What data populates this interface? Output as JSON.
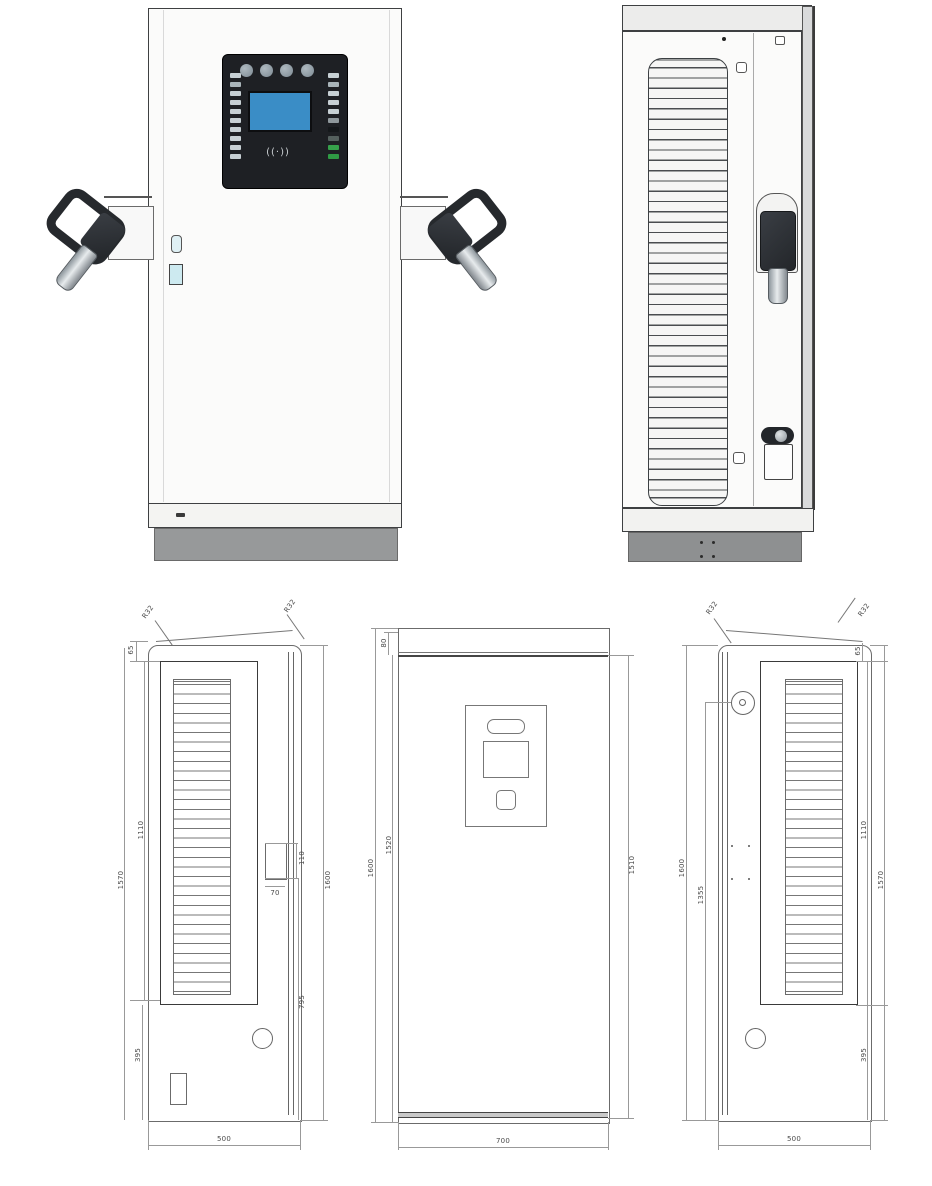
{
  "front_render": {
    "rfid_symbol": "((·))",
    "screen_color": "#3a8dc6",
    "panel_color": "#1e2024",
    "led_colors_left": [
      "#c7d0d4",
      "#a9b4b9",
      "#c7d0d4",
      "#c7d0d4",
      "#c7d0d4",
      "#c7d0d4",
      "#c7d0d4",
      "#c7d0d4",
      "#c7d0d4",
      "#c7d0d4"
    ],
    "led_colors_right": [
      "#c7d0d4",
      "#a9b4b9",
      "#c7d0d4",
      "#c7d0d4",
      "#c7d0d4",
      "#8f989c",
      "#15181b",
      "#55605e",
      "#36a14b",
      "#2f9a44"
    ]
  },
  "drawings": {
    "left": {
      "r32_left": "R32",
      "r32_right": "R32",
      "top_inset": "65",
      "overall": "1570",
      "louver": "1110",
      "cutout_h": "110",
      "cutout_w": "70",
      "full_height": "1600",
      "lower": "795",
      "base": "395",
      "depth": "500"
    },
    "front": {
      "top_panel": "80",
      "full_height": "1600",
      "door": "1520",
      "side": "1510",
      "width": "700"
    },
    "right": {
      "r32_left": "R32",
      "r32_right": "R32",
      "top_inset": "65",
      "full_height": "1600",
      "hinge": "1355",
      "louver": "1110",
      "overall": "1570",
      "base": "395",
      "depth": "500"
    }
  }
}
